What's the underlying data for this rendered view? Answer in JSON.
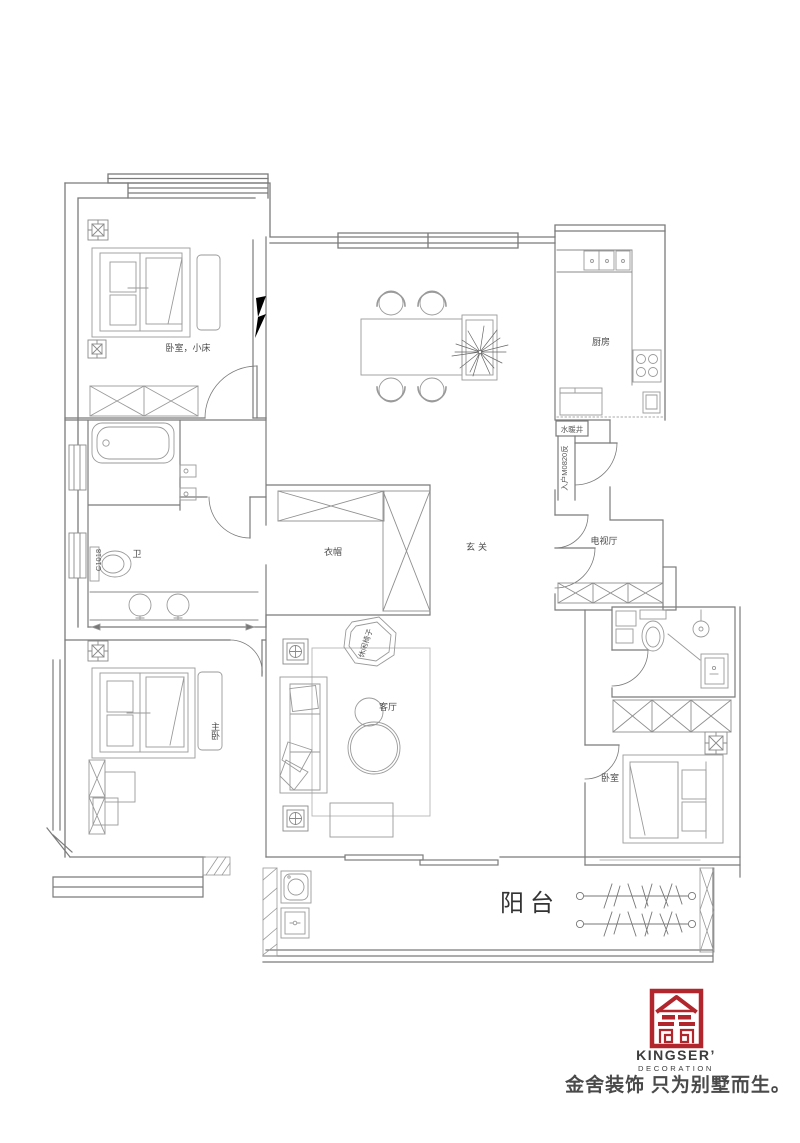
{
  "plan": {
    "line_color": "#8a8a8a",
    "labels": {
      "bedroom_small": "卧室，小床",
      "kitchen": "厨房",
      "shaft": "水暖井",
      "entry_door": "入户M0820反",
      "window_code": "C1018",
      "bath": "卫",
      "cloakroom": "衣帽",
      "foyer": "玄关",
      "tv_hall": "电视厅",
      "leisure_chair": "休闲椅子",
      "living_room": "客厅",
      "master_bedroom": "主卧",
      "bedroom": "卧室",
      "balcony": "阳台"
    }
  },
  "brand": {
    "logo_text": "KINGSER’",
    "logo_sub": "DECORATION",
    "slogan": "金舍装饰 只为别墅而生。",
    "logo_color": "#b0262c",
    "text_color": "#3d3d3d"
  }
}
